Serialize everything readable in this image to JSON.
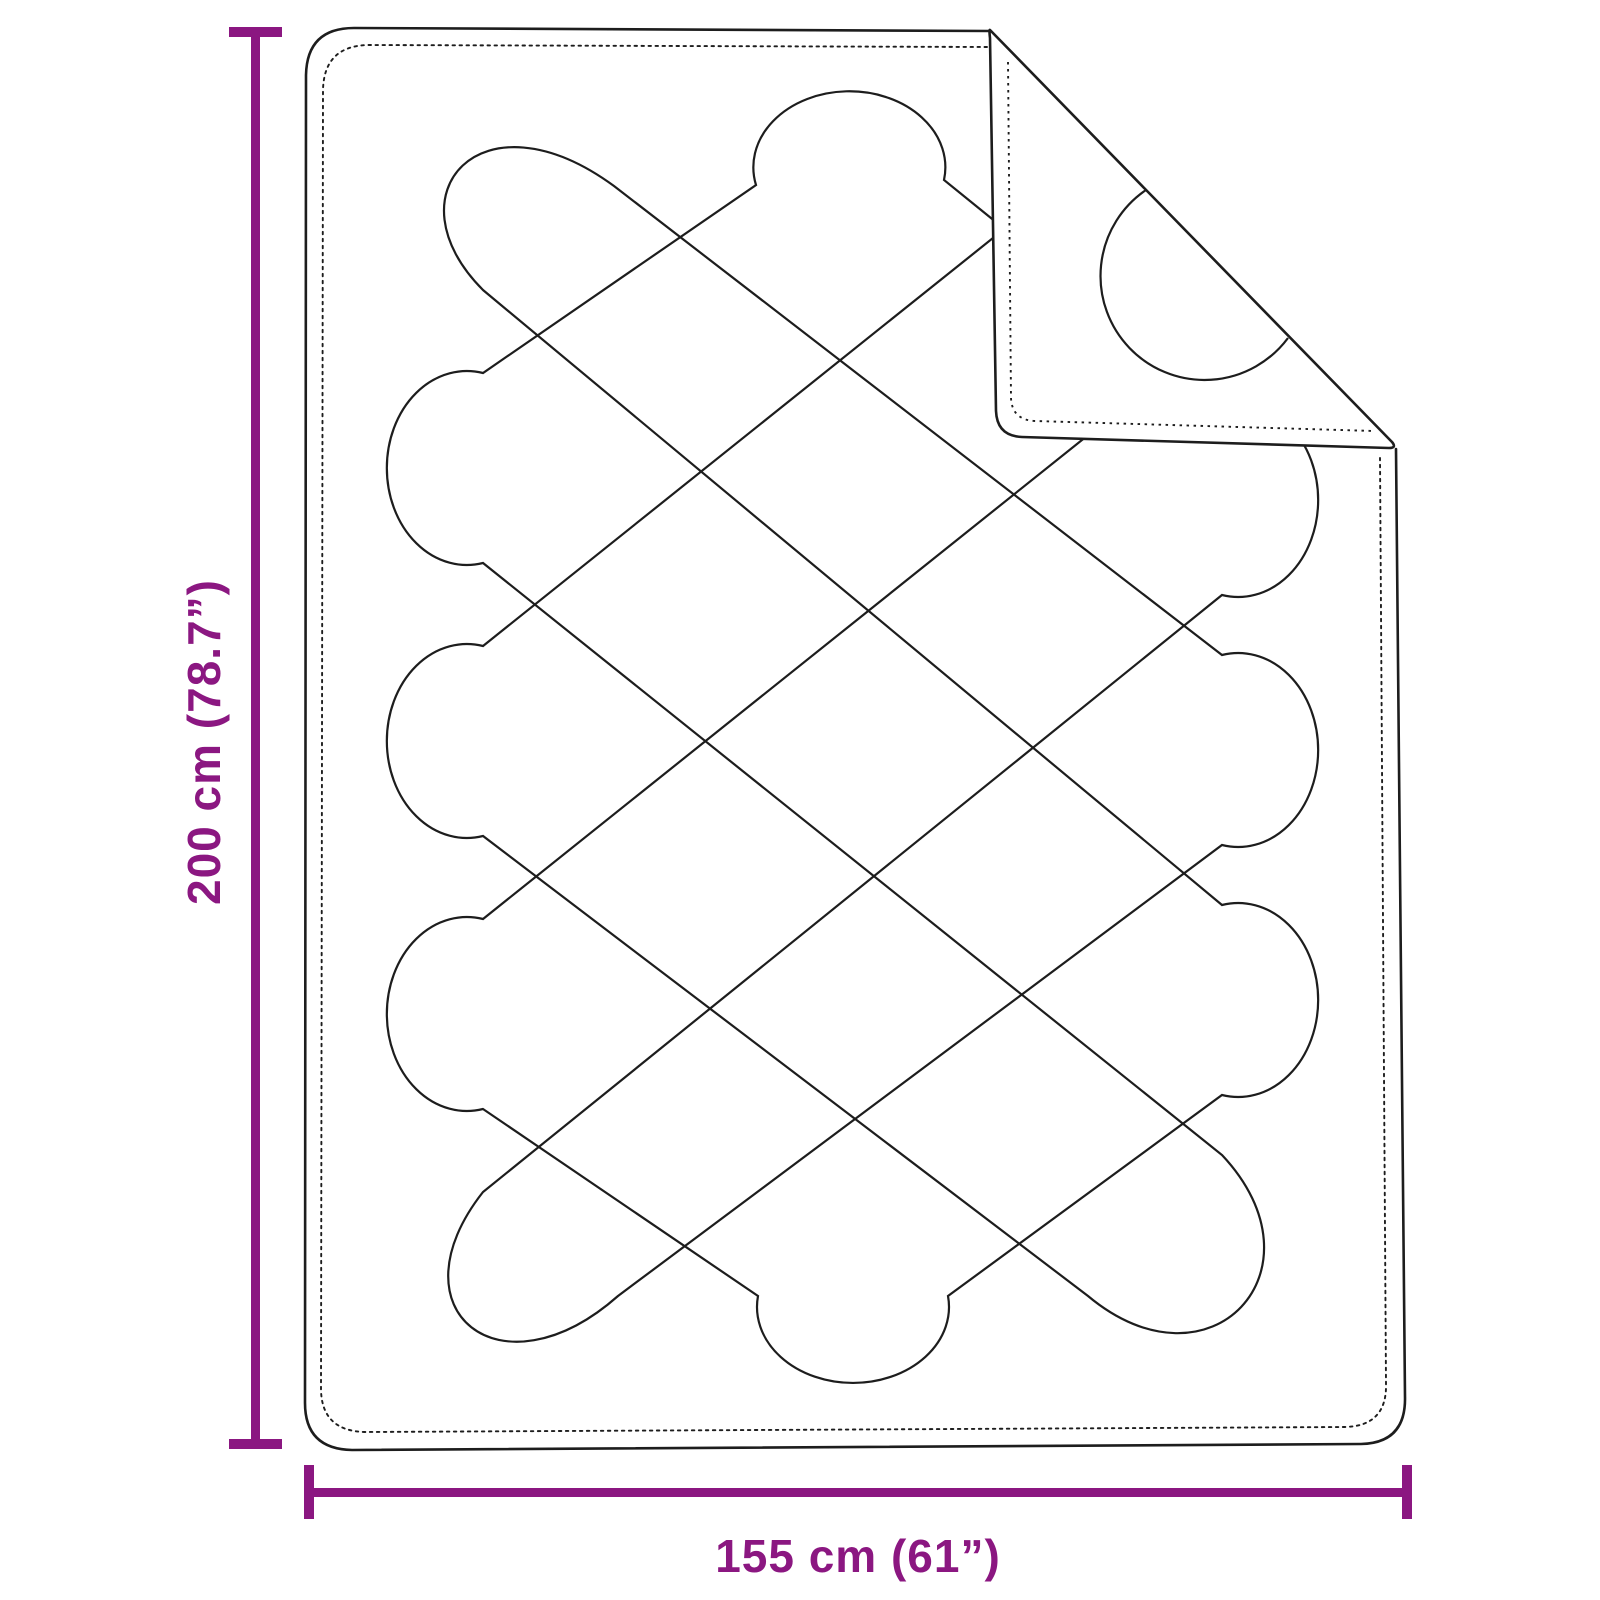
{
  "figure": {
    "kind": "product-dimension-diagram",
    "subject": "quilted-blanket-with-folded-corner"
  },
  "dimensions": {
    "height_label": "200 cm (78.7”)",
    "width_label": "155 cm (61”)"
  },
  "colors": {
    "accent": "#8B1781",
    "outline": "#1d1d1d",
    "background": "#ffffff"
  }
}
